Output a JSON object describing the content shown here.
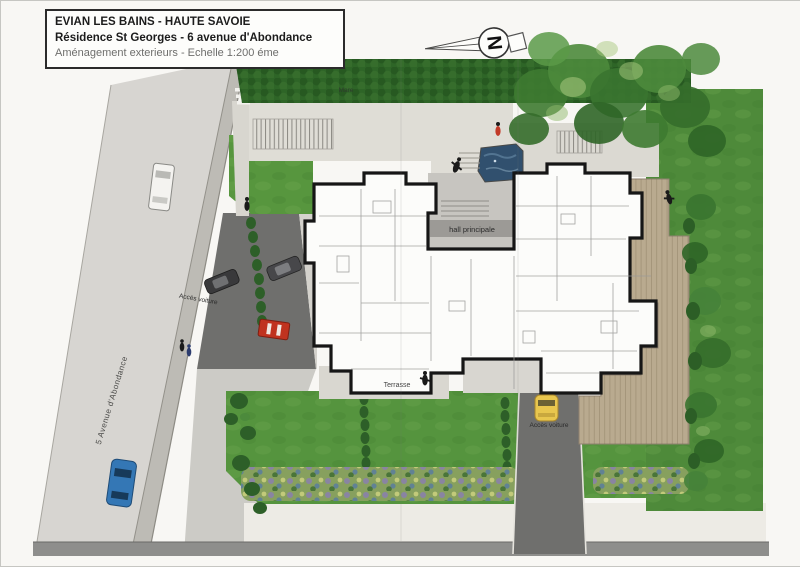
{
  "document": {
    "title_line1": "EVIAN LES BAINS - HAUTE SAVOIE",
    "title_line2": "Résidence St Georges - 6 avenue d'Abondance",
    "title_line3": "Aménagement exterieurs - Echelle 1:200 éme"
  },
  "compass": {
    "north_letter": "N"
  },
  "plan_labels": {
    "pond": "Mare",
    "main_hall": "hall principale",
    "terrace": "Terrasse",
    "car_access_west": "Accès voiture",
    "car_access_south": "Accès voiture",
    "street_name": "5 Avenue d'Abondance"
  },
  "palette": {
    "road": "#d7d5d1",
    "sidewalk": "#bdbbb5",
    "driveway_dark": "#6f6f6d",
    "paving_light": "#dfddd6",
    "lawn_green": "#55943e",
    "hedge_green": "#2c6426",
    "deck_wood": "#b9aa8f",
    "building_outline": "#161616",
    "pond_water": "#31506e",
    "car_yellow": "#e8c64e",
    "car_blue": "#3477b5",
    "car_red": "#c0331f"
  }
}
